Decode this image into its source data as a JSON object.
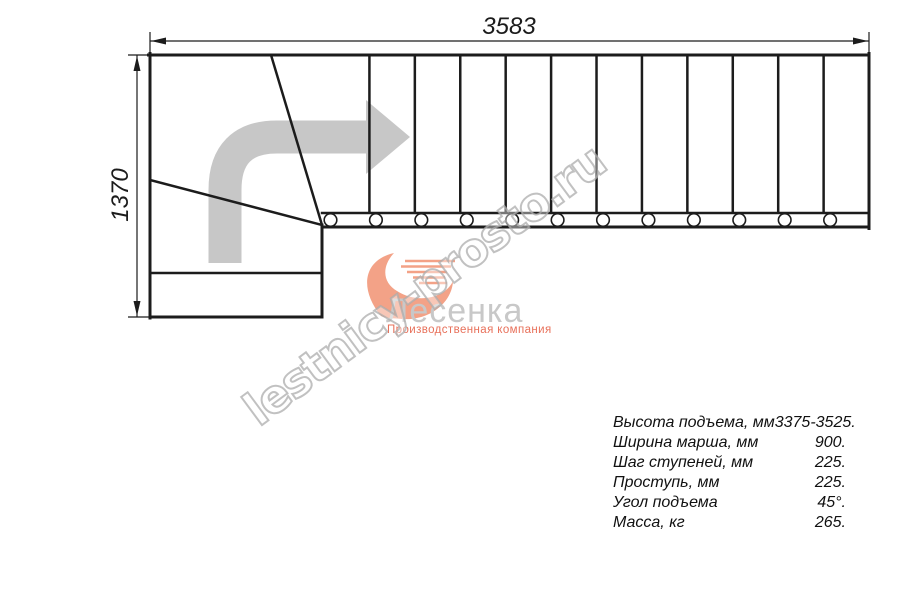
{
  "drawing": {
    "dim_width_label": "3583",
    "dim_height_label": "1370",
    "tread_line_count": 11,
    "post_count": 12
  },
  "logo": {
    "company": "Лесенка",
    "tagline": "Производственная компания",
    "bird_icon": "swoosh-bird-icon"
  },
  "watermark": {
    "text": "lestnicy-prosto.ru"
  },
  "specs": {
    "rows": [
      {
        "label": "Высота подъема, мм",
        "value": "3375-3525."
      },
      {
        "label": "Ширина марша, мм",
        "value": "900."
      },
      {
        "label": "Шаг ступеней, мм",
        "value": "225."
      },
      {
        "label": "Проступь, мм",
        "value": "225."
      },
      {
        "label": "Угол подъема",
        "value": "45°."
      },
      {
        "label": "Масса, кг",
        "value": "265."
      }
    ]
  },
  "colors": {
    "line": "#1c1c1c",
    "arrow_gray": "#c7c7c7",
    "logo_salmon": "#f3a287",
    "logo_text_gray": "#c8c8c8",
    "tagline_salmon": "#e8705a",
    "watermark_gray": "#acacac"
  }
}
